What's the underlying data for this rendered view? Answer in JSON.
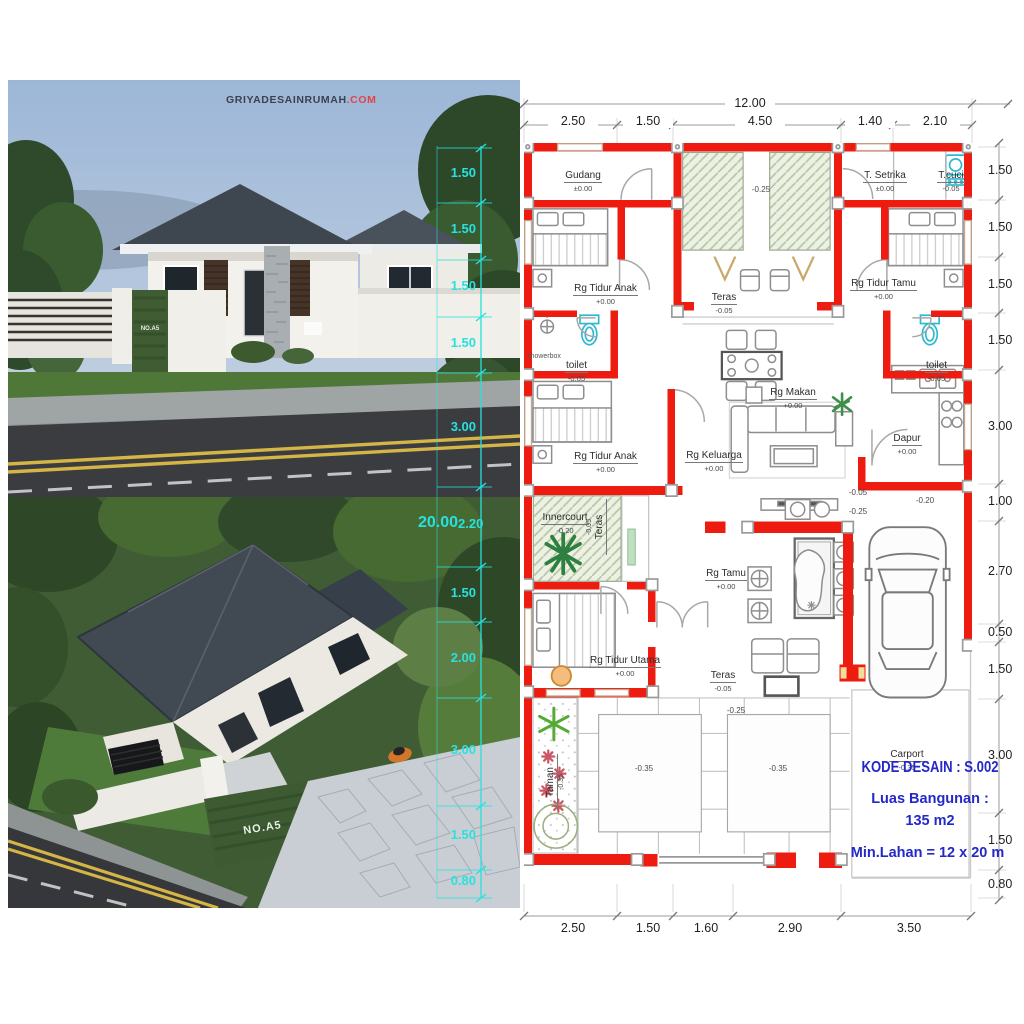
{
  "brand": {
    "name": "GRIYADESAINRUMAH",
    "suffix": ".COM"
  },
  "renders": {
    "house_number": "NO.A5"
  },
  "overlay_dims": {
    "total": "20.00",
    "segments": [
      "1.50",
      "1.50",
      "1.50",
      "1.50",
      "3.00",
      "2.20",
      "1.50",
      "2.00",
      "3.00",
      "1.50",
      "0.80"
    ]
  },
  "plan": {
    "dims": {
      "top_total": "12.00",
      "top": [
        "2.50",
        "1.50",
        "4.50",
        "1.40",
        "2.10"
      ],
      "right": [
        "1.50",
        "1.50",
        "1.50",
        "1.50",
        "3.00",
        "1.00",
        "2.70",
        "0.50",
        "1.50",
        "3.00",
        "1.50",
        "0.80"
      ],
      "bottom": [
        "2.50",
        "1.50",
        "1.60",
        "2.90",
        "3.50"
      ]
    },
    "rooms": [
      {
        "name": "Gudang",
        "level": "±0.00"
      },
      {
        "name": "T. Setrika",
        "level": "±0.00"
      },
      {
        "name": "T.cuci",
        "level": "-0.05"
      },
      {
        "name": "Rg Tidur Anak",
        "level": "+0.00"
      },
      {
        "name": "Teras",
        "level": "-0.05"
      },
      {
        "name": "Rg Tidur Tamu",
        "level": "+0.00"
      },
      {
        "name": "toilet",
        "level": "-0.05"
      },
      {
        "name": "showerbox",
        "level": ""
      },
      {
        "name": "toilet",
        "level": "-0.05"
      },
      {
        "name": "Rg Tidur Anak",
        "level": "+0.00"
      },
      {
        "name": "Rg Makan",
        "level": "+0.00"
      },
      {
        "name": "Rg Keluarga",
        "level": "+0.00"
      },
      {
        "name": "Dapur",
        "level": "+0.00"
      },
      {
        "name": "Innercourt",
        "level": "-0.20"
      },
      {
        "name": "Teras",
        "level": "-0.05"
      },
      {
        "name": "Rg Tamu",
        "level": "+0.00"
      },
      {
        "name": "Rg Tidur Utama",
        "level": "+0.00"
      },
      {
        "name": "Teras",
        "level": "-0.05"
      },
      {
        "name": "Taman",
        "level": "-0.35"
      },
      {
        "name": "Carport",
        "level": "-0.35"
      }
    ],
    "spot_levels": [
      "-0.25",
      "-0.05",
      "-0.25",
      "-0.20",
      "-0.25",
      "-0.35",
      "-0.35"
    ],
    "info": {
      "kode": "KODE DESAIN : S.002",
      "luas_label": "Luas Bangunan :",
      "luas_value": "135 m2",
      "lahan": "Min.Lahan = 12 x 20 m"
    }
  },
  "colors": {
    "wall_red": "#ee1c10",
    "info_blue": "#2428c8",
    "overlay_cyan": "#27e2de"
  }
}
